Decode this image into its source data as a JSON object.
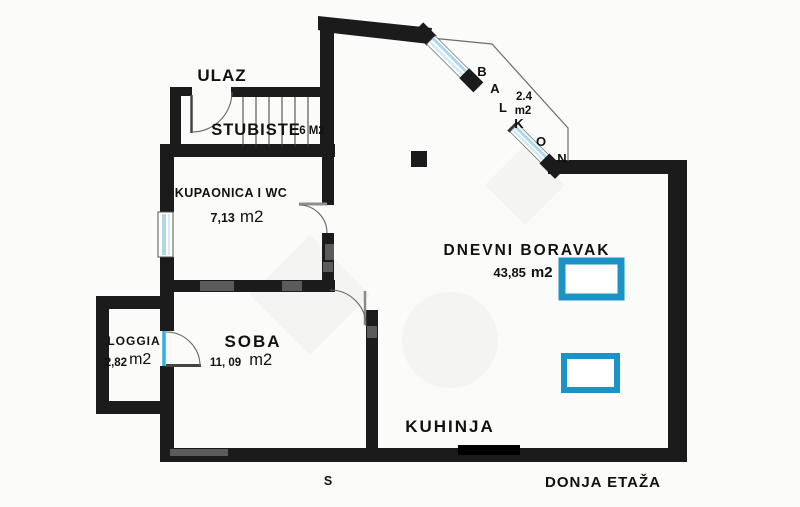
{
  "floor_plan": {
    "entrance_label": "ULAZ",
    "staircase": {
      "label": "STUBISTE",
      "area": "6 M2"
    },
    "bathroom": {
      "label": "KUPAONICA I WC",
      "area": "7,13",
      "unit": "m2"
    },
    "balcony": {
      "letters": [
        "B",
        "A",
        "L",
        "K",
        "O",
        "N"
      ],
      "area": "2.4",
      "unit": "m2"
    },
    "living_room": {
      "label": "DNEVNI BORAVAK",
      "area": "43,85",
      "unit": "m2"
    },
    "loggia": {
      "label": "LOGGIA",
      "area": "2,82",
      "unit": "m2"
    },
    "room": {
      "label": "SOBA",
      "area": "11, 09",
      "unit": "m2"
    },
    "kitchen": {
      "label": "KUHINJA"
    },
    "compass": "S",
    "floor_label": "DONJA ETAŽA",
    "colors": {
      "wall": "#1b1b1b",
      "window_glass": "#aed8e9",
      "door_glass": "#2fb2e2",
      "furniture_outline": "#1c93c6"
    }
  }
}
